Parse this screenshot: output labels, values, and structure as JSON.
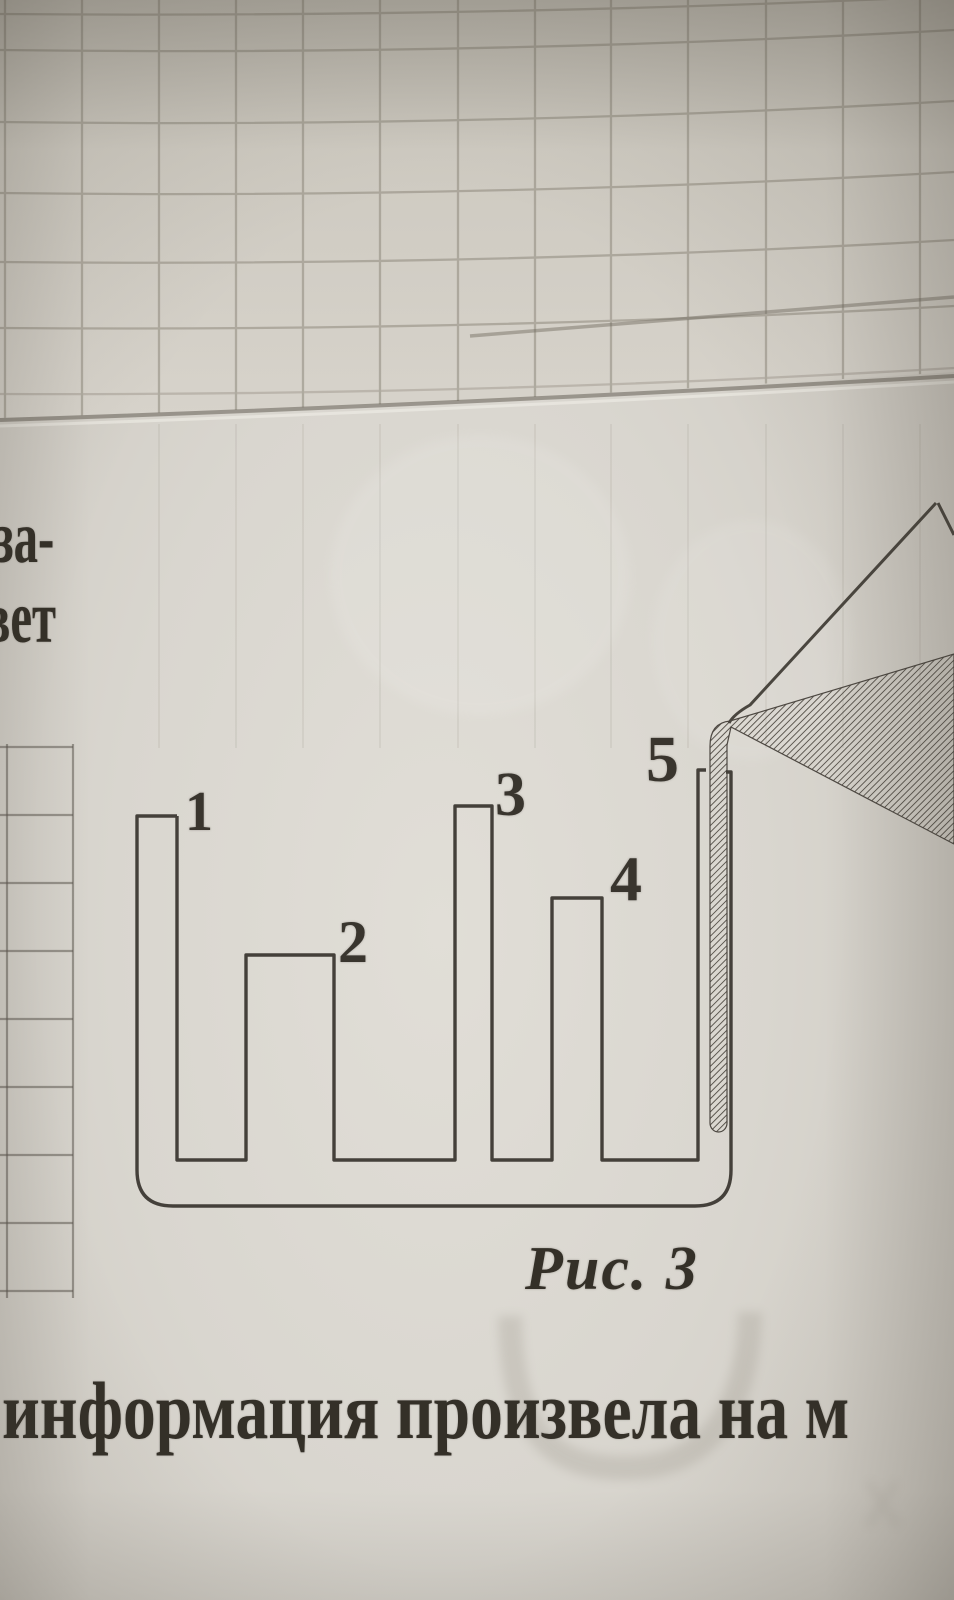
{
  "figure": {
    "caption": "Рис. 3",
    "tube_labels": [
      "1",
      "2",
      "3",
      "4",
      "5"
    ]
  },
  "margin_text_fragments": {
    "line1": "за-",
    "line2": "вет"
  },
  "bottom_text_fragment": "информация произвела на м",
  "colors": {
    "paper": "#d9d6cf",
    "ink": "#44403a",
    "grid_line": "#8f897d",
    "text_ink": "#343028"
  }
}
